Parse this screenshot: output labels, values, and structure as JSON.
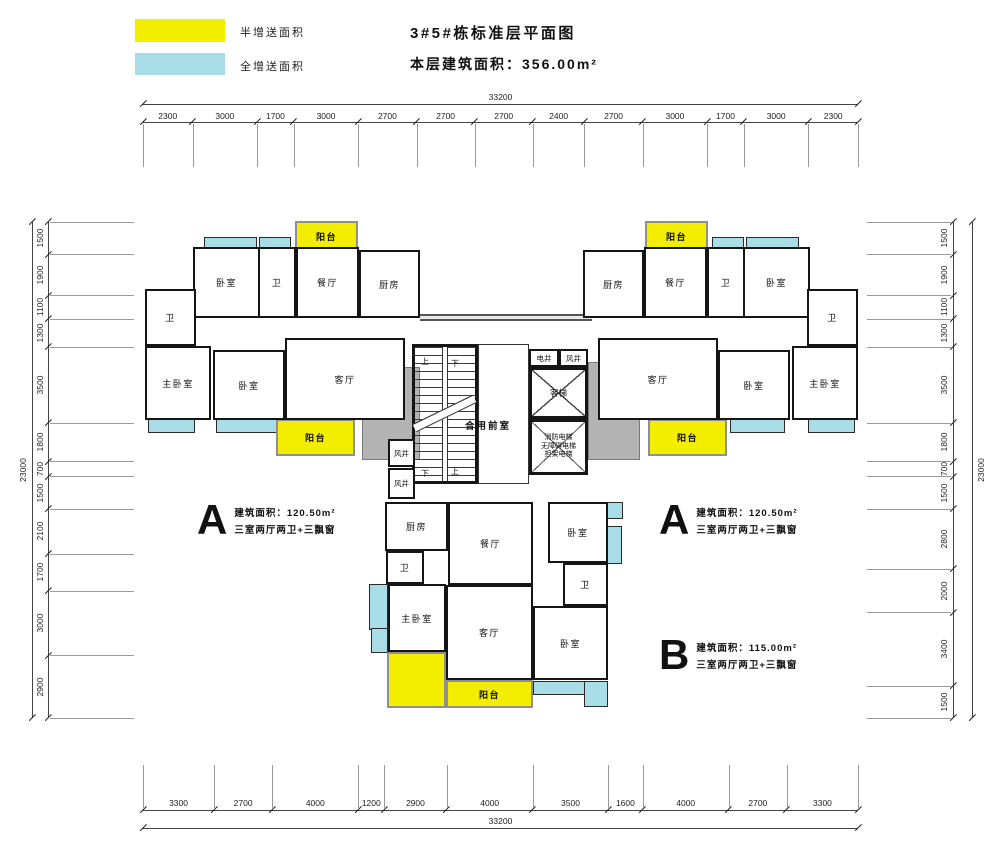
{
  "legend": {
    "items": [
      {
        "label": "半增送面积",
        "color": "#f3ee00"
      },
      {
        "label": "全增送面积",
        "color": "#a8dce6"
      }
    ]
  },
  "title": {
    "line1": "3#5#栋标准层平面图",
    "line2": "本层建筑面积：356.00m²"
  },
  "units": [
    {
      "id": "A",
      "area": "建筑面积：120.50m²",
      "desc": "三室两厅两卫+三飘窗"
    },
    {
      "id": "A",
      "area": "建筑面积：120.50m²",
      "desc": "三室两厅两卫+三飘窗"
    },
    {
      "id": "B",
      "area": "建筑面积：115.00m²",
      "desc": "三室两厅两卫+三飘窗"
    }
  ],
  "dimensions": {
    "top": {
      "total": "33200",
      "segments": [
        "2300",
        "3000",
        "1700",
        "3000",
        "2700",
        "2700",
        "2700",
        "2400",
        "2700",
        "3000",
        "1700",
        "3000",
        "2300"
      ]
    },
    "bottom": {
      "total": "33200",
      "segments": [
        "3300",
        "2700",
        "4000",
        "1200",
        "2900",
        "4000",
        "3500",
        "1600",
        "4000",
        "2700",
        "3300"
      ]
    },
    "left": {
      "total": "23000",
      "segments": [
        "1500",
        "1900",
        "1100",
        "1300",
        "3500",
        "1800",
        "700",
        "1500",
        "2100",
        "1700",
        "3000",
        "2900"
      ]
    },
    "right": {
      "total": "23000",
      "segments": [
        "1500",
        "1900",
        "1100",
        "1300",
        "3500",
        "1800",
        "700",
        "1500",
        "2800",
        "2000",
        "3400",
        "1500"
      ]
    }
  },
  "plan": {
    "colors": {
      "balcony": "#f3ee00",
      "bay": "#a8dce6",
      "slab": "#b3b3b3",
      "wall": "#151515"
    },
    "rooms": [
      {
        "id": "balcony-top-left",
        "k": "balcony",
        "label": "阳台",
        "x": 295,
        "y": 221,
        "w": 63,
        "h": 30
      },
      {
        "id": "bay-left-1",
        "k": "bay",
        "x": 204,
        "y": 237,
        "w": 53,
        "h": 13
      },
      {
        "id": "bay-left-2",
        "k": "bay",
        "x": 259,
        "y": 237,
        "w": 32,
        "h": 13
      },
      {
        "id": "bedroom-top-left",
        "k": "room",
        "label": "卧室",
        "x": 193,
        "y": 247,
        "w": 67,
        "h": 71
      },
      {
        "id": "bath-mid-left",
        "k": "room",
        "label": "卫",
        "x": 258,
        "y": 247,
        "w": 38,
        "h": 71
      },
      {
        "id": "dining-left",
        "k": "room",
        "label": "餐厅",
        "x": 296,
        "y": 247,
        "w": 63,
        "h": 71
      },
      {
        "id": "kitchen-left",
        "k": "room",
        "label": "厨房",
        "x": 359,
        "y": 250,
        "w": 61,
        "h": 68
      },
      {
        "id": "bath-far-left",
        "k": "room",
        "label": "卫",
        "x": 145,
        "y": 289,
        "w": 51,
        "h": 57
      },
      {
        "id": "master-left",
        "k": "room",
        "label": "主卧室",
        "x": 145,
        "y": 346,
        "w": 66,
        "h": 74
      },
      {
        "id": "bedroom-bot-left",
        "k": "room",
        "label": "卧室",
        "x": 213,
        "y": 350,
        "w": 72,
        "h": 70
      },
      {
        "id": "living-left",
        "k": "room",
        "label": "客厅",
        "x": 285,
        "y": 338,
        "w": 120,
        "h": 82
      },
      {
        "id": "bay-left-3",
        "k": "bay",
        "x": 148,
        "y": 418,
        "w": 47,
        "h": 15
      },
      {
        "id": "bay-left-4",
        "k": "bay",
        "x": 216,
        "y": 418,
        "w": 69,
        "h": 15
      },
      {
        "id": "balcony-bot-left",
        "k": "balcony",
        "label": "阳台",
        "x": 276,
        "y": 419,
        "w": 79,
        "h": 37
      },
      {
        "id": "slab-left",
        "k": "slab",
        "label": "结构板",
        "x": 362,
        "y": 367,
        "w": 58,
        "h": 93
      },
      {
        "id": "window-wall-top",
        "k": "wwall",
        "x": 420,
        "y": 314,
        "w": 172,
        "h": 7
      },
      {
        "id": "front-room",
        "k": "roomthin",
        "x": 478,
        "y": 344,
        "w": 51,
        "h": 140
      },
      {
        "id": "stair",
        "k": "stair",
        "x": 412,
        "y": 344,
        "w": 66,
        "h": 140
      },
      {
        "id": "stair-up-top",
        "k": "tiny",
        "label": "上",
        "x": 418,
        "y": 356,
        "w": 14,
        "h": 10
      },
      {
        "id": "stair-down-top",
        "k": "tiny",
        "label": "下",
        "x": 448,
        "y": 358,
        "w": 14,
        "h": 10
      },
      {
        "id": "stair-down-bot",
        "k": "tiny",
        "label": "下",
        "x": 418,
        "y": 468,
        "w": 14,
        "h": 10
      },
      {
        "id": "stair-up-bot",
        "k": "tiny",
        "label": "上",
        "x": 448,
        "y": 466,
        "w": 14,
        "h": 10
      },
      {
        "id": "front-room-label",
        "k": "ptext",
        "label": "合用前室",
        "x": 448,
        "y": 418,
        "w": 80,
        "h": 14
      },
      {
        "id": "shaft-electric",
        "k": "shaft",
        "label": "电井",
        "x": 529,
        "y": 349,
        "w": 30,
        "h": 18
      },
      {
        "id": "shaft-wind-top",
        "k": "shaft",
        "label": "风井",
        "x": 559,
        "y": 349,
        "w": 29,
        "h": 18
      },
      {
        "id": "elevator-passenger",
        "k": "elev",
        "label": "客梯",
        "x": 529,
        "y": 367,
        "w": 59,
        "h": 52
      },
      {
        "id": "elevator-fire",
        "k": "elev3",
        "lines": [
          "消防电梯",
          "无障碍电梯",
          "担架电梯"
        ],
        "x": 529,
        "y": 419,
        "w": 59,
        "h": 56
      },
      {
        "id": "shaft-wind-1",
        "k": "shaft",
        "label": "风井",
        "x": 388,
        "y": 439,
        "w": 27,
        "h": 28
      },
      {
        "id": "shaft-wind-2",
        "k": "shaft",
        "label": "风井",
        "x": 388,
        "y": 468,
        "w": 27,
        "h": 31
      },
      {
        "id": "slab-right",
        "k": "slab",
        "label": "结构板",
        "x": 588,
        "y": 362,
        "w": 52,
        "h": 98
      },
      {
        "id": "balcony-top-right",
        "k": "balcony",
        "label": "阳台",
        "x": 645,
        "y": 221,
        "w": 63,
        "h": 30
      },
      {
        "id": "bay-right-1",
        "k": "bay",
        "x": 712,
        "y": 237,
        "w": 32,
        "h": 13
      },
      {
        "id": "bay-right-2",
        "k": "bay",
        "x": 746,
        "y": 237,
        "w": 53,
        "h": 13
      },
      {
        "id": "kitchen-right",
        "k": "room",
        "label": "厨房",
        "x": 583,
        "y": 250,
        "w": 61,
        "h": 68
      },
      {
        "id": "dining-right",
        "k": "room",
        "label": "餐厅",
        "x": 644,
        "y": 247,
        "w": 63,
        "h": 71
      },
      {
        "id": "bath-mid-right",
        "k": "room",
        "label": "卫",
        "x": 707,
        "y": 247,
        "w": 38,
        "h": 71
      },
      {
        "id": "bedroom-top-right",
        "k": "room",
        "label": "卧室",
        "x": 743,
        "y": 247,
        "w": 67,
        "h": 71
      },
      {
        "id": "bath-far-right",
        "k": "room",
        "label": "卫",
        "x": 807,
        "y": 289,
        "w": 51,
        "h": 57
      },
      {
        "id": "living-right",
        "k": "room",
        "label": "客厅",
        "x": 598,
        "y": 338,
        "w": 120,
        "h": 82
      },
      {
        "id": "bedroom-bot-right",
        "k": "room",
        "label": "卧室",
        "x": 718,
        "y": 350,
        "w": 72,
        "h": 70
      },
      {
        "id": "master-right",
        "k": "room",
        "label": "主卧室",
        "x": 792,
        "y": 346,
        "w": 66,
        "h": 74
      },
      {
        "id": "bay-right-3",
        "k": "bay",
        "x": 730,
        "y": 418,
        "w": 55,
        "h": 15
      },
      {
        "id": "bay-right-4",
        "k": "bay",
        "x": 808,
        "y": 418,
        "w": 47,
        "h": 15
      },
      {
        "id": "balcony-bot-right",
        "k": "balcony",
        "label": "阳台",
        "x": 648,
        "y": 419,
        "w": 79,
        "h": 37
      },
      {
        "id": "kitchen-b",
        "k": "room",
        "label": "厨房",
        "x": 385,
        "y": 502,
        "w": 63,
        "h": 49
      },
      {
        "id": "dining-b",
        "k": "room",
        "label": "餐厅",
        "x": 448,
        "y": 502,
        "w": 85,
        "h": 83
      },
      {
        "id": "bedroom-b-top",
        "k": "room",
        "label": "卧室",
        "x": 548,
        "y": 502,
        "w": 60,
        "h": 61
      },
      {
        "id": "bath-b-left",
        "k": "room",
        "label": "卫",
        "x": 386,
        "y": 551,
        "w": 38,
        "h": 33
      },
      {
        "id": "bath-b-right",
        "k": "room",
        "label": "卫",
        "x": 563,
        "y": 563,
        "w": 45,
        "h": 43
      },
      {
        "id": "master-b",
        "k": "room",
        "label": "主卧室",
        "x": 388,
        "y": 584,
        "w": 58,
        "h": 68
      },
      {
        "id": "living-b",
        "k": "room",
        "label": "客厅",
        "x": 446,
        "y": 585,
        "w": 87,
        "h": 95
      },
      {
        "id": "bedroom-b-bot",
        "k": "room",
        "label": "卧室",
        "x": 533,
        "y": 606,
        "w": 75,
        "h": 74
      },
      {
        "id": "bay-b-1",
        "k": "bay",
        "x": 369,
        "y": 584,
        "w": 19,
        "h": 46
      },
      {
        "id": "bay-b-2",
        "k": "bay",
        "x": 371,
        "y": 628,
        "w": 17,
        "h": 25
      },
      {
        "id": "bay-b-3",
        "k": "bay",
        "x": 607,
        "y": 502,
        "w": 16,
        "h": 17
      },
      {
        "id": "bay-b-4",
        "k": "bay",
        "x": 604,
        "y": 526,
        "w": 18,
        "h": 38
      },
      {
        "id": "bay-b-5",
        "k": "bay",
        "x": 533,
        "y": 681,
        "w": 55,
        "h": 14
      },
      {
        "id": "bay-b-6",
        "k": "bay",
        "x": 584,
        "y": 681,
        "w": 24,
        "h": 26
      },
      {
        "id": "balcony-b-left",
        "k": "balcony",
        "x": 387,
        "y": 652,
        "w": 59,
        "h": 56
      },
      {
        "id": "balcony-b-bottom",
        "k": "balcony",
        "label": "阳台",
        "x": 446,
        "y": 680,
        "w": 87,
        "h": 28
      }
    ]
  }
}
